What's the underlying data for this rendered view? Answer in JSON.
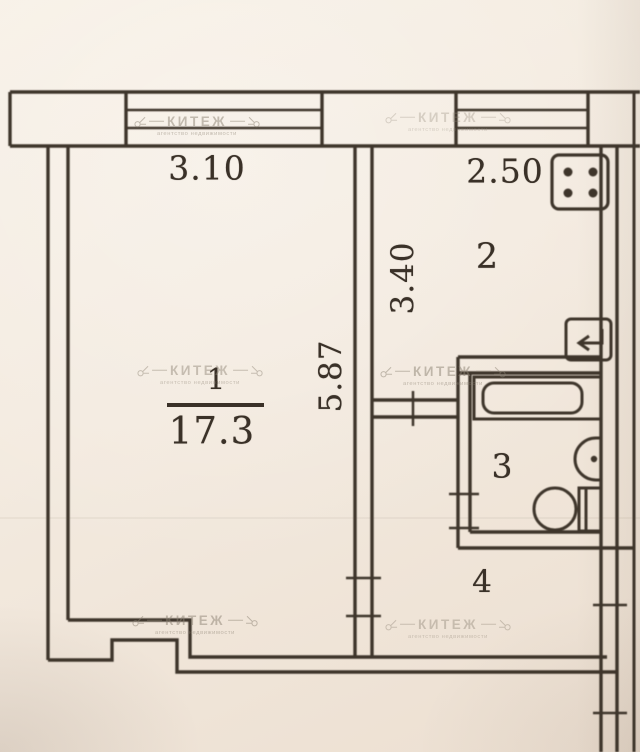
{
  "document": {
    "type": "apartment floor plan (scanned photo)"
  },
  "watermark": {
    "text": "КИТЕЖ",
    "subtext": "агентство недвижимости"
  },
  "rooms": [
    {
      "number": "1",
      "area": "17.3"
    },
    {
      "number": "2"
    },
    {
      "number": "3"
    },
    {
      "number": "4"
    }
  ],
  "dimensions": {
    "room1_width_m": "3.10",
    "room1_depth_m": "5.87",
    "kitchen_width_m": "2.50",
    "kitchen_depth_m": "3.40"
  },
  "fixtures": [
    "stove-icon",
    "vent-arrow-icon",
    "bathtub-icon",
    "sink-icon",
    "toilet-icon"
  ],
  "colors": {
    "paper": "#f3ebe0",
    "ink": "#3e352b",
    "watermark": "#8d8374"
  }
}
